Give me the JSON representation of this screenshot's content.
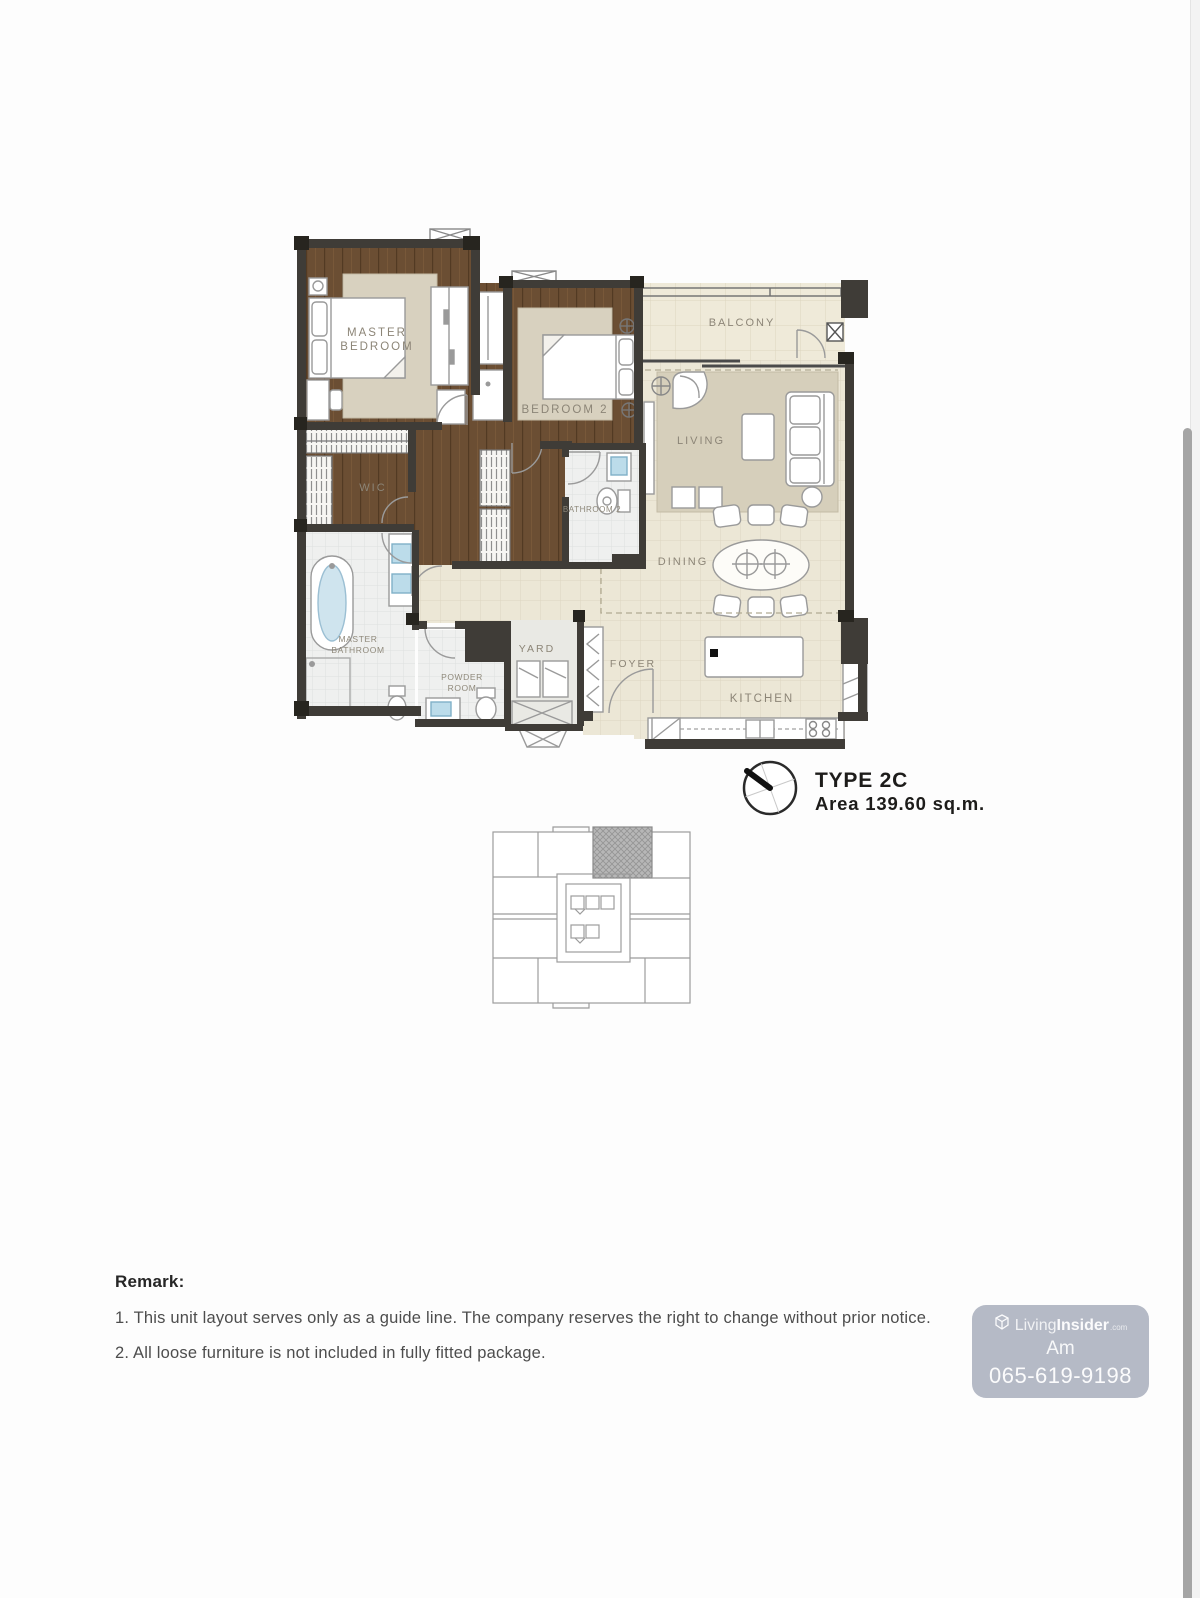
{
  "floor_plan": {
    "rooms": {
      "master_bedroom": {
        "line1": "MASTER",
        "line2": "BEDROOM"
      },
      "bedroom_2": "BEDROOM 2",
      "balcony": "BALCONY",
      "living": "LIVING",
      "wic": "WIC",
      "bathroom_2": "BATHROOM 2",
      "dining": "DINING",
      "master_bathroom": {
        "line1": "MASTER",
        "line2": "BATHROOM"
      },
      "powder_room": {
        "line1": "POWDER",
        "line2": "ROOM"
      },
      "yard": "YARD",
      "foyer": "FOYER",
      "kitchen": "KITCHEN"
    },
    "unit": {
      "type_label": "TYPE 2C",
      "area_label": "Area 139.60 sq.m."
    },
    "colors": {
      "wall": "#3f3c37",
      "wood_floor": "#6b4e33",
      "rug": "#d8d1bf",
      "tile_floor": "#ece7d6",
      "bath_floor": "#eff0ef",
      "accent_blue": "#bcdcea",
      "label_text": "#8c8577",
      "watermark_bg": "#b5bac6"
    }
  },
  "remark": {
    "heading": "Remark:",
    "items": [
      "1. This unit layout serves only as a guide line. The company reserves the right to change without prior notice.",
      "2. All loose furniture is not included in fully fitted package."
    ]
  },
  "watermark": {
    "brand_light": "Living",
    "brand_bold": "Insider",
    "brand_suffix": ".com",
    "name": "Am",
    "phone": "065-619-9198"
  }
}
